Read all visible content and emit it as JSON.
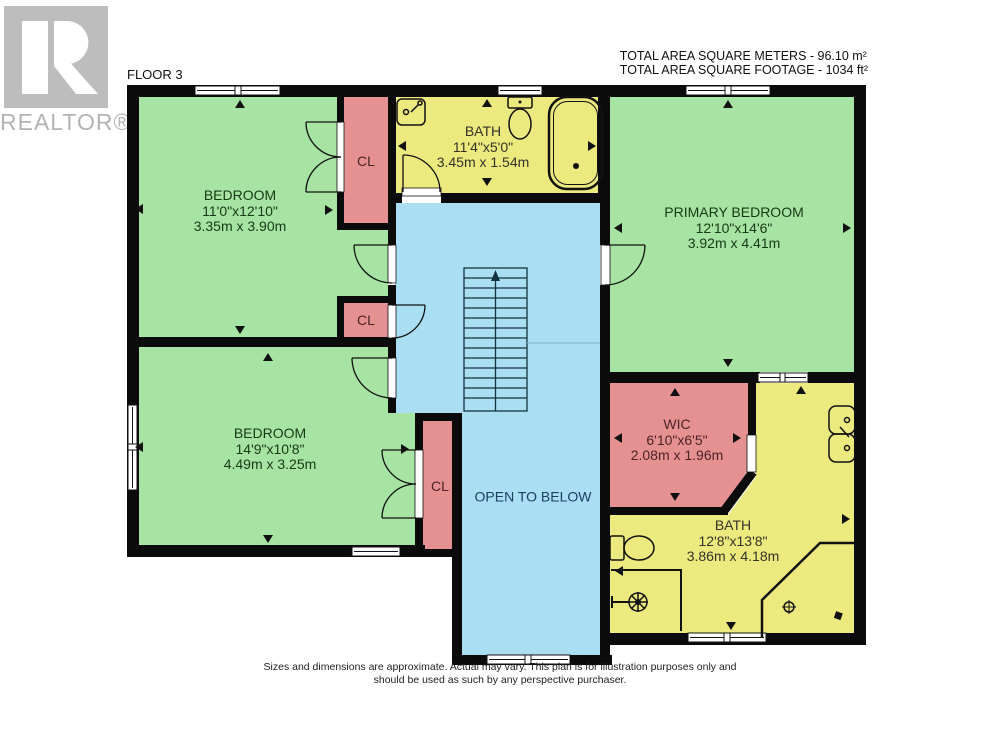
{
  "logo": {
    "letter": "R",
    "brand": "REALTOR®"
  },
  "header": {
    "floor_label": "FLOOR 3",
    "area_meters": "TOTAL AREA SQUARE METERS - 96.10 m²",
    "area_footage": "TOTAL AREA SQUARE FOOTAGE - 1034 ft²"
  },
  "rooms": {
    "bedroom1": {
      "name": "BEDROOM",
      "imperial": "11'0\"x12'10\"",
      "metric": "3.35m x 3.90m"
    },
    "bath1": {
      "name": "BATH",
      "imperial": "11'4\"x5'0\"",
      "metric": "3.45m x 1.54m"
    },
    "primary": {
      "name": "PRIMARY BEDROOM",
      "imperial": "12'10\"x14'6\"",
      "metric": "3.92m x 4.41m"
    },
    "bedroom2": {
      "name": "BEDROOM",
      "imperial": "14'9\"x10'8\"",
      "metric": "4.49m x 3.25m"
    },
    "wic": {
      "name": "WIC",
      "imperial": "6'10\"x6'5\"",
      "metric": "2.08m x 1.96m"
    },
    "bath2": {
      "name": "BATH",
      "imperial": "12'8\"x13'8\"",
      "metric": "3.86m x 4.18m"
    }
  },
  "labels": {
    "closet": "CL",
    "open_to_below": "OPEN TO BELOW"
  },
  "disclaimer": {
    "line1": "Sizes and dimensions are approximate. Actual may vary. This plan is for illustration purposes only and",
    "line2": "should be used as such by any perspective purchaser."
  },
  "colors": {
    "room_green": "#a7e3a2",
    "room_yellow": "#ece97e",
    "room_pink": "#e69191",
    "hall_blue": "#a9def3",
    "wall_black": "#0b0b0b",
    "logo_gray": "#bdbdbd"
  }
}
